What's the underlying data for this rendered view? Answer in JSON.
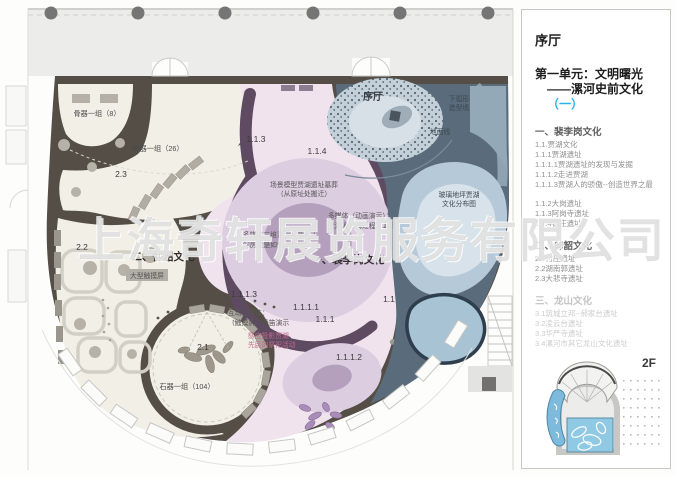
{
  "watermark": {
    "text": "上海奇轩展览服务有限公司"
  },
  "colors": {
    "accent_cyan": "#29b3e8",
    "wall_dark": "#544e46",
    "floor_cream": "#f2efe6",
    "floor_pink": "#f1e3ee",
    "ring_lavender": "#dccde1",
    "ring_core": "#b4a0bc",
    "band_purple": "#5e4b61",
    "zone_slate": "#5a6b7b",
    "glass_blue": "#b6c9d8",
    "minimap_blue": "#7ebadb",
    "label_pink": "#c2688a"
  },
  "plan": {
    "labels": {
      "bone_group": "骨器一组（8）",
      "pottery_group": "陶器一组（26）",
      "code_2_3": "2.3",
      "code_2_2": "2.2",
      "sec_yangshao": "二、仰韶文化",
      "touch_screen": "大型触摸屏",
      "code_2_1": "2.1",
      "stone_group": "石器一组（104）",
      "code_1_1_3": "1.1.3",
      "code_1_1_4": "1.1.4",
      "scene_model_l1": "场景模型贾湖遗址墓葬",
      "scene_model_l2": "（从原址处搬迁）",
      "media_anim_l1": "多媒体（动画演示）：",
      "media_anim_l2": "贾湖人制陶过程",
      "code_1_1_2": "1.1.2",
      "media_3d_l1": "多媒体三维演示：贾湖人",
      "media_3d_l2": "的房屋是如何建造的？",
      "sec_peiligang": "一、裴李岗文化",
      "code_1_1_1_3": "1.1.1.3",
      "code_1_1": "1.1",
      "code_1_1_1_1": "1.1.1.1",
      "interactive_l1": "互动多媒体：",
      "interactive_l2": "（触摸屏）骨笛演示",
      "code_1_1_1": "1.1.1",
      "projection_l1": "感应投影贾湖",
      "projection_l2": "先民的祭祀活动",
      "code_1_1_1_2": "1.1.1.2",
      "xuting": "序厅",
      "arc_wall_l1": "下弧形",
      "arc_wall_l2": "造型墙",
      "ground_line": "地面线",
      "glass_floor_l1": "玻璃地坪贾湖",
      "glass_floor_l2": "文化分布图"
    }
  },
  "sidebar": {
    "title": "序厅",
    "unit_line1": "第一单元：文明曙光",
    "unit_line2_prefix": "——漯河史前文化",
    "unit_line2_highlight": "（一）",
    "sections": [
      {
        "heading": "一、裴李岗文化",
        "muted": false,
        "items": [
          "1.1.贾湖文化",
          "1.1.1贾湖遗址",
          "1.1.1.1贾湖遗址的发现与发掘",
          "1.1.1.2走进贾湖",
          "1.1.1.3贾湖人的骄傲--创造世界之最",
          "",
          "1.1.2大岗遗址",
          "1.1.3阿岗寺遗址",
          "1.1.4翟庄遗址"
        ]
      },
      {
        "heading": "二、仰韶文化",
        "muted": false,
        "items": [
          "2.1付庄遗址",
          "2.2湖南郭遗址",
          "2.3大悲寺遗址"
        ]
      },
      {
        "heading": "三、龙山文化",
        "muted": true,
        "items": [
          "3.1筑城立邦--郝家台遗址",
          "3.2凌云台遗址",
          "3.3华严寺遗址",
          "3.4漯河市其它龙山文化遗址"
        ]
      }
    ],
    "floor_label": "2F"
  }
}
